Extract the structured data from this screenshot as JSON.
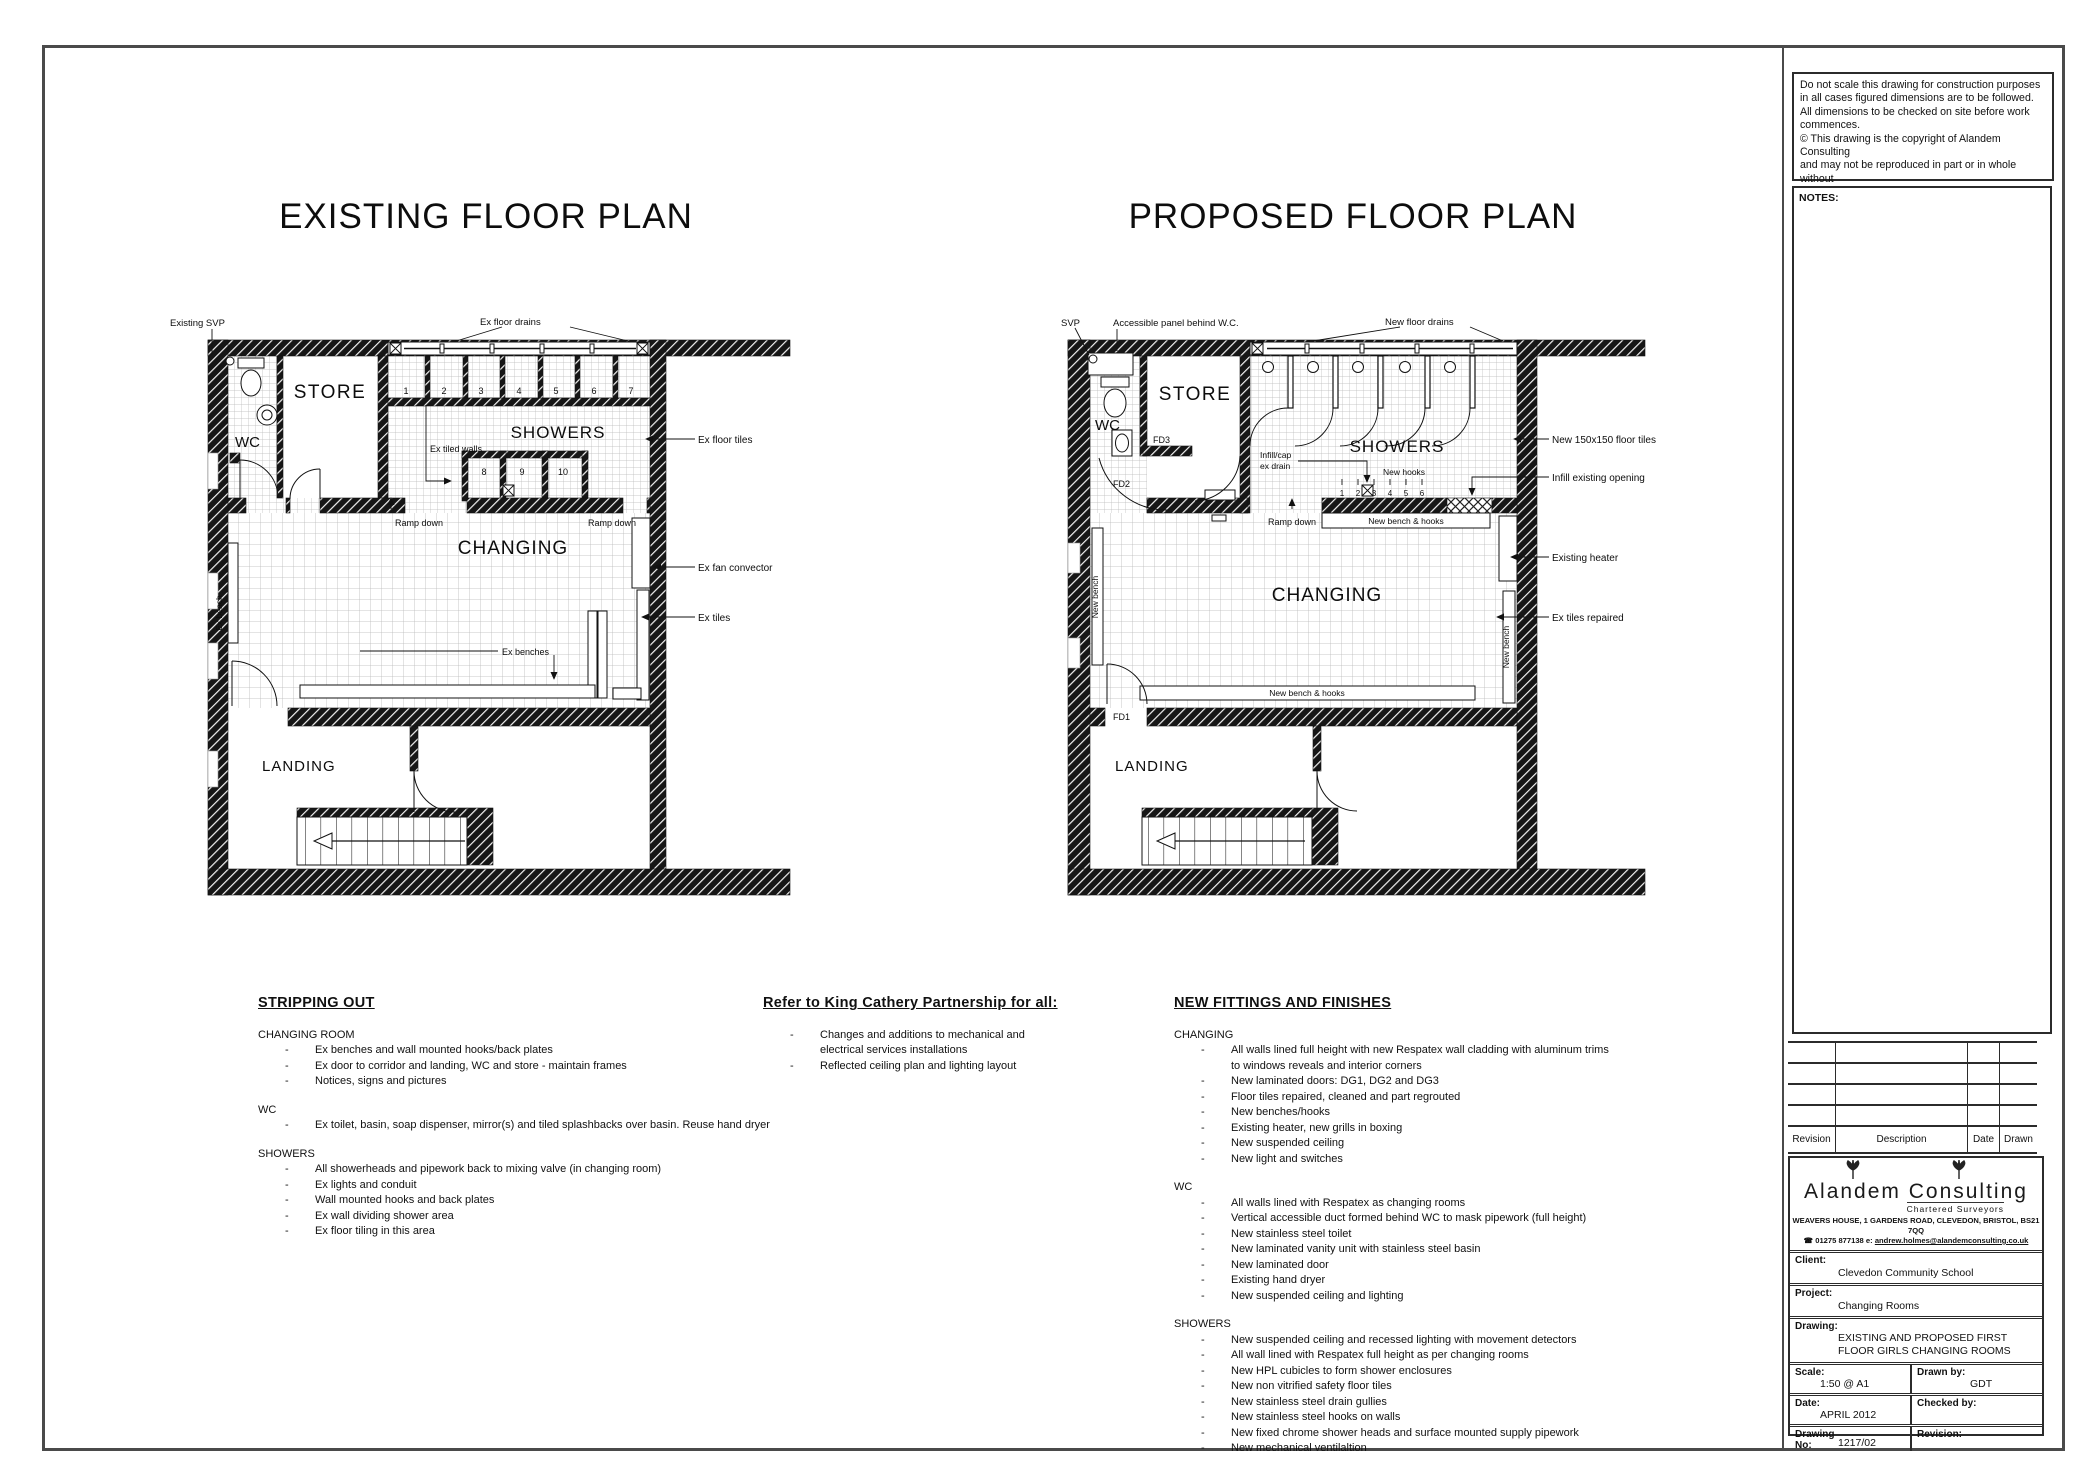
{
  "page": {
    "existing_title": "EXISTING FLOOR PLAN",
    "proposed_title": "PROPOSED FLOOR PLAN"
  },
  "copyright": {
    "lines": [
      "Do not scale this drawing for construction purposes",
      "in all cases figured dimensions are to be followed.",
      "All dimensions to be checked on site before work",
      "commences.",
      "© This drawing is the copyright of Alandem Consulting",
      "and may not be reproduced in part or in whole without",
      "prior written permission."
    ]
  },
  "notes": {
    "label": "NOTES:"
  },
  "revision_table": {
    "headers": [
      "Revision",
      "Description",
      "Date",
      "Drawn"
    ]
  },
  "title_block": {
    "company": "Alandem Consulting",
    "tagline": "Chartered Surveyors",
    "address": "WEAVERS HOUSE, 1 GARDENS ROAD, CLEVEDON, BRISTOL, BS21 7QQ",
    "phone_icon": "☎",
    "phone": "01275 877138",
    "email_prefix": "e:",
    "email": "andrew.holmes@alandemconsulting.co.uk",
    "client_label": "Client:",
    "client": "Clevedon Community School",
    "project_label": "Project:",
    "project": "Changing Rooms",
    "drawing_label": "Drawing:",
    "drawing_line1": "EXISTING AND PROPOSED FIRST",
    "drawing_line2": "FLOOR GIRLS CHANGING ROOMS",
    "scale_label": "Scale:",
    "scale": "1:50 @ A1",
    "drawn_by_label": "Drawn by:",
    "drawn_by": "GDT",
    "date_label": "Date:",
    "date": "APRIL 2012",
    "checked_by_label": "Checked by:",
    "checked_by": "",
    "drawing_no_label1": "Drawing",
    "drawing_no_label2": "No:",
    "drawing_no": "1217/02",
    "revision_label": "Revision:",
    "revision": ""
  },
  "sections": {
    "stripping_out": {
      "title": "STRIPPING OUT",
      "groups": [
        {
          "heading": "CHANGING ROOM",
          "items": [
            "Ex benches and wall mounted hooks/back plates",
            "Ex door to corridor and landing, WC and store - maintain frames",
            "Notices, signs and pictures"
          ]
        },
        {
          "heading": "WC",
          "items": [
            "Ex toilet, basin, soap dispenser, mirror(s) and tiled splashbacks over basin. Reuse hand dryer"
          ]
        },
        {
          "heading": "SHOWERS",
          "items": [
            "All showerheads and pipework back to mixing valve (in changing room)",
            "Ex lights and conduit",
            "Wall mounted hooks and back plates",
            "Ex wall dividing shower area",
            "Ex floor tiling in this area"
          ]
        }
      ]
    },
    "refer": {
      "title": "Refer to King Cathery Partnership for all:",
      "items": [
        "Changes and additions to mechanical and electrical services installations",
        "Reflected ceiling plan and lighting layout"
      ]
    },
    "new_fittings": {
      "title": "NEW FITTINGS AND FINISHES",
      "groups": [
        {
          "heading": "CHANGING",
          "items": [
            "All walls lined full height with new Respatex wall cladding with aluminum trims to windows reveals and interior corners",
            "New laminated doors: DG1, DG2 and DG3",
            "Floor tiles repaired, cleaned and part regrouted",
            "New benches/hooks",
            "Existing heater, new grills in boxing",
            "New suspended ceiling",
            "New light and switches"
          ]
        },
        {
          "heading": "WC",
          "items": [
            "All walls lined with Respatex as changing rooms",
            "Vertical accessible duct formed behind WC to mask pipework (full height)",
            "New stainless steel toilet",
            "New laminated vanity unit with stainless steel basin",
            "New laminated door",
            "Existing hand dryer",
            "New suspended ceiling and lighting"
          ]
        },
        {
          "heading": "SHOWERS",
          "items": [
            "New suspended ceiling and recessed lighting with movement detectors",
            "All wall lined with Respatex full height as per changing rooms",
            "New HPL cubicles to form shower enclosures",
            "New non vitrified safety floor tiles",
            "New stainless steel drain gullies",
            "New stainless steel hooks on walls",
            "New fixed chrome shower heads and surface mounted supply pipework",
            "New mechanical ventilaltion"
          ]
        }
      ]
    }
  },
  "existing_plan": {
    "labels": {
      "svp": "Existing SVP",
      "floor_drains": "Ex floor drains",
      "store": "STORE",
      "wc": "WC",
      "showers": "SHOWERS",
      "tiled_walls": "Ex tiled walls",
      "floor_tiles": "Ex floor tiles",
      "ramp_down_1": "Ramp down",
      "ramp_down_2": "Ramp down",
      "changing": "CHANGING",
      "fan_convector": "Ex fan convector",
      "tiles": "Ex tiles",
      "benches": "Ex benches",
      "bench": "Ex bench",
      "landing": "LANDING"
    },
    "numbers_row1": [
      "1",
      "2",
      "3",
      "4",
      "5",
      "6",
      "7"
    ],
    "numbers_row2": [
      "8",
      "9",
      "10"
    ]
  },
  "proposed_plan": {
    "labels": {
      "svp": "SVP",
      "access_panel": "Accessible panel behind W.C.",
      "floor_drains": "New floor drains",
      "store": "STORE",
      "wc": "WC",
      "fd1": "FD1",
      "fd2": "FD2",
      "fd3": "FD3",
      "showers": "SHOWERS",
      "infill_cap_1": "Infill/cap",
      "infill_cap_2": "ex drain",
      "new_hooks": "New hooks",
      "new_tiles": "New 150x150 floor tiles",
      "infill_opening": "Infill existing opening",
      "bench_hooks_top": "New bench & hooks",
      "heater": "Existing heater",
      "tiles_repaired": "Ex tiles repaired",
      "ramp_down": "Ramp down",
      "changing": "CHANGING",
      "new_bench_left": "New bench",
      "new_bench_right": "New bench",
      "bench_hooks_bottom": "New bench & hooks",
      "landing": "LANDING"
    },
    "hook_numbers": [
      "1",
      "2",
      "3",
      "4",
      "5",
      "6"
    ]
  }
}
